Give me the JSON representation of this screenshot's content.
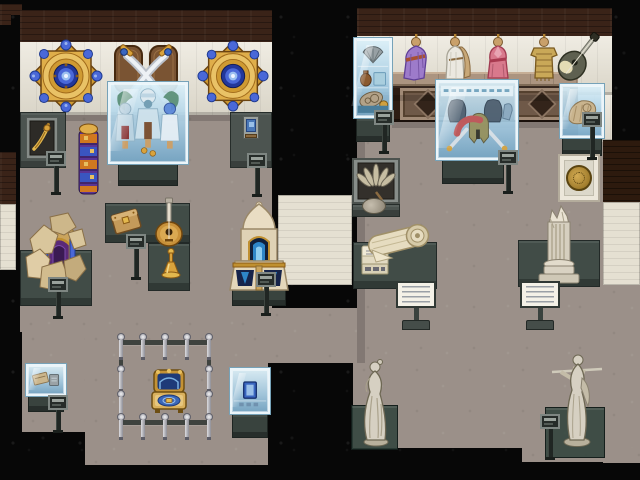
{
  "scene": {
    "domain": "game",
    "description": "Pixel-art museum interior with two exhibit galleries, glass display cases, pedestals, placards and statues",
    "visible_text": [],
    "palette": {
      "void": "#070707",
      "floor": "#9b9089",
      "wall_cream": "#e7e2d4",
      "wall_brown": "#3a2318",
      "pedestal": "#414c47",
      "glass_light": "#dbf0f9",
      "glass_deep": "#74a6c6",
      "gold": "#d9a33c",
      "royal_blue": "#3a66b8",
      "marble": "#d6d0c2"
    },
    "left_gallery": {
      "wall_decor": [
        {
          "id": "mandala-left",
          "label": "Round mandala ornament"
        },
        {
          "id": "crossed-swords",
          "label": "Crossed scimitars plaque"
        },
        {
          "id": "mandala-right",
          "label": "Round mandala ornament"
        }
      ],
      "exhibits": [
        {
          "id": "costume-case",
          "label": "Desert costume display case"
        },
        {
          "id": "dagger-display",
          "label": "Golden dagger wall display"
        },
        {
          "id": "totem-pole",
          "label": "Painted totem pole"
        },
        {
          "id": "framed-picture",
          "label": "Small framed picture"
        },
        {
          "id": "ruins-gate",
          "label": "Excavated gate ruins"
        },
        {
          "id": "wooden-box",
          "label": "Carved wooden box"
        },
        {
          "id": "lute",
          "label": "Round-bodied lute"
        },
        {
          "id": "golden-flask",
          "label": "Golden flask"
        },
        {
          "id": "shrine-monument",
          "label": "Ivory shrine monument"
        },
        {
          "id": "royal-bed",
          "label": "Royal bed behind stanchions"
        },
        {
          "id": "book-case",
          "label": "Blue tome display case"
        },
        {
          "id": "relic-case",
          "label": "Small relic display case"
        }
      ]
    },
    "right_gallery": {
      "wall_decor": [
        {
          "id": "pottery-cabinet",
          "label": "Pottery and curios cabinet"
        },
        {
          "id": "mannequin-purple",
          "label": "Purple robe mannequin"
        },
        {
          "id": "mannequin-toga",
          "label": "White toga mannequin"
        },
        {
          "id": "mannequin-pink",
          "label": "Pink dress mannequin"
        },
        {
          "id": "mannequin-tunic",
          "label": "Gilded tunic mannequin"
        },
        {
          "id": "wall-lute",
          "label": "Mounted lute"
        },
        {
          "id": "shell-cabinet",
          "label": "Shell display cabinet"
        },
        {
          "id": "fan-frame",
          "label": "Framed feather fan"
        },
        {
          "id": "medallion-frame",
          "label": "Framed gold medallion"
        }
      ],
      "exhibits": [
        {
          "id": "greek-armor-case",
          "label": "Hoplite armor display case"
        },
        {
          "id": "scroll-exhibit",
          "label": "Ancient scroll and documents"
        },
        {
          "id": "column-exhibit",
          "label": "Broken marble column"
        },
        {
          "id": "statue-woman",
          "label": "Marble statue of a woman"
        },
        {
          "id": "statue-warrior",
          "label": "Marble statue of a spearman"
        }
      ]
    },
    "signage": {
      "placard_count": 10,
      "info_sign_count": 2,
      "placard_label": "exhibit placard",
      "info_sign_label": "information sign"
    }
  }
}
